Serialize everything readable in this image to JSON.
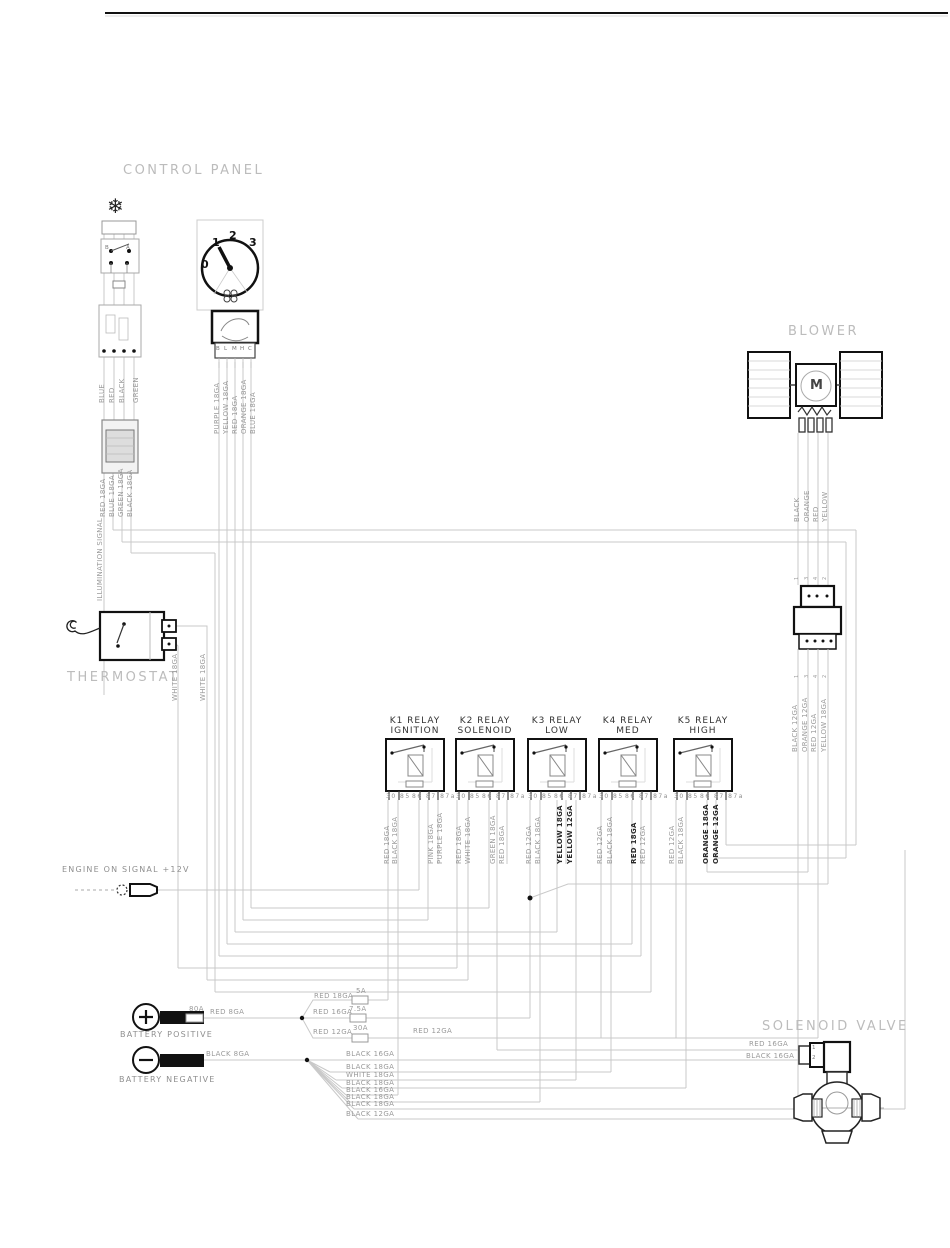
{
  "sections": {
    "control_panel": {
      "label": "CONTROL PANEL"
    },
    "blower": {
      "label": "BLOWER"
    },
    "thermostat": {
      "label": "THERMOSTAT"
    },
    "solenoid_valve": {
      "label": "SOLENOID VALVE"
    }
  },
  "control_panel": {
    "top_wires": [
      "BLUE",
      "RED",
      "BLACK",
      "GREEN"
    ],
    "connector_wires": [
      "RED 18GA",
      "BLUE 18GA",
      "GREEN 18GA",
      "BLACK 18GA"
    ],
    "illumination": "ILLUMINATION SIGNAL",
    "dial_positions": [
      "0",
      "1",
      "2",
      "3"
    ],
    "selector_scale": [
      "B",
      "L",
      "M",
      "H",
      "C"
    ],
    "switch_contacts": [
      "B",
      "A"
    ],
    "selector_wires": [
      "PURPLE 18GA",
      "YELLOW 18GA",
      "RED 18GA",
      "ORANGE 18GA",
      "BLUE 18GA"
    ],
    "snowflake_icon": "❄"
  },
  "thermostat": {
    "wires": [
      "WHITE 18GA",
      "WHITE 18GA"
    ]
  },
  "blower": {
    "motor_letter": "M",
    "wires_upper": [
      "BLACK",
      "ORANGE",
      "RED",
      "YELLOW"
    ],
    "connector_pins": [
      "1",
      "3",
      "4",
      "2"
    ],
    "wires_lower": [
      "BLACK 12GA",
      "ORANGE 12GA",
      "RED 12GA",
      "YELLOW 18GA"
    ]
  },
  "relays": {
    "pins_left": "30 85",
    "pins_right": "86 87 87a",
    "items": [
      {
        "name": "K1 RELAY",
        "func": "IGNITION"
      },
      {
        "name": "K2 RELAY",
        "func": "SOLENOID"
      },
      {
        "name": "K3 RELAY",
        "func": "LOW"
      },
      {
        "name": "K4 RELAY",
        "func": "MED"
      },
      {
        "name": "K5 RELAY",
        "func": "HIGH"
      }
    ],
    "wire_labels": [
      "RED 18GA",
      "BLACK 18GA",
      "PINK 18GA",
      "PURPLE 18GA",
      "RED 18GA",
      "WHITE 18GA",
      "GREEN 18GA",
      "RED 18GA",
      "RED 12GA",
      "BLACK 18GA",
      "YELLOW 18GA",
      "YELLOW 12GA",
      "RED 12GA",
      "BLACK 18GA",
      "RED 18GA",
      "RED 12GA",
      "RED 12GA",
      "BLACK 18GA",
      "ORANGE 18GA",
      "ORANGE 12GA"
    ]
  },
  "engine_signal": "ENGINE ON SIGNAL +12V",
  "battery": {
    "positive_label": "BATTERY POSITIVE",
    "negative_label": "BATTERY NEGATIVE",
    "main_fuse": "80A",
    "positive_wire": "RED 8GA",
    "negative_wire": "BLACK 8GA",
    "branches": [
      {
        "wire": "RED 18GA",
        "fuse": "5A"
      },
      {
        "wire": "RED 16GA",
        "fuse": "7.5A"
      },
      {
        "wire": "RED 12GA",
        "fuse": "30A"
      }
    ],
    "branch_continuation": "RED 12GA",
    "negative_branches": [
      "BLACK 16GA",
      "BLACK 18GA",
      "WHITE 18GA",
      "BLACK 18GA",
      "BLACK 16GA",
      "BLACK 18GA",
      "BLACK 18GA",
      "BLACK 12GA"
    ]
  },
  "solenoid_valve": {
    "wires": [
      "RED 16GA",
      "BLACK 16GA"
    ],
    "pins": [
      "1",
      "2"
    ]
  }
}
